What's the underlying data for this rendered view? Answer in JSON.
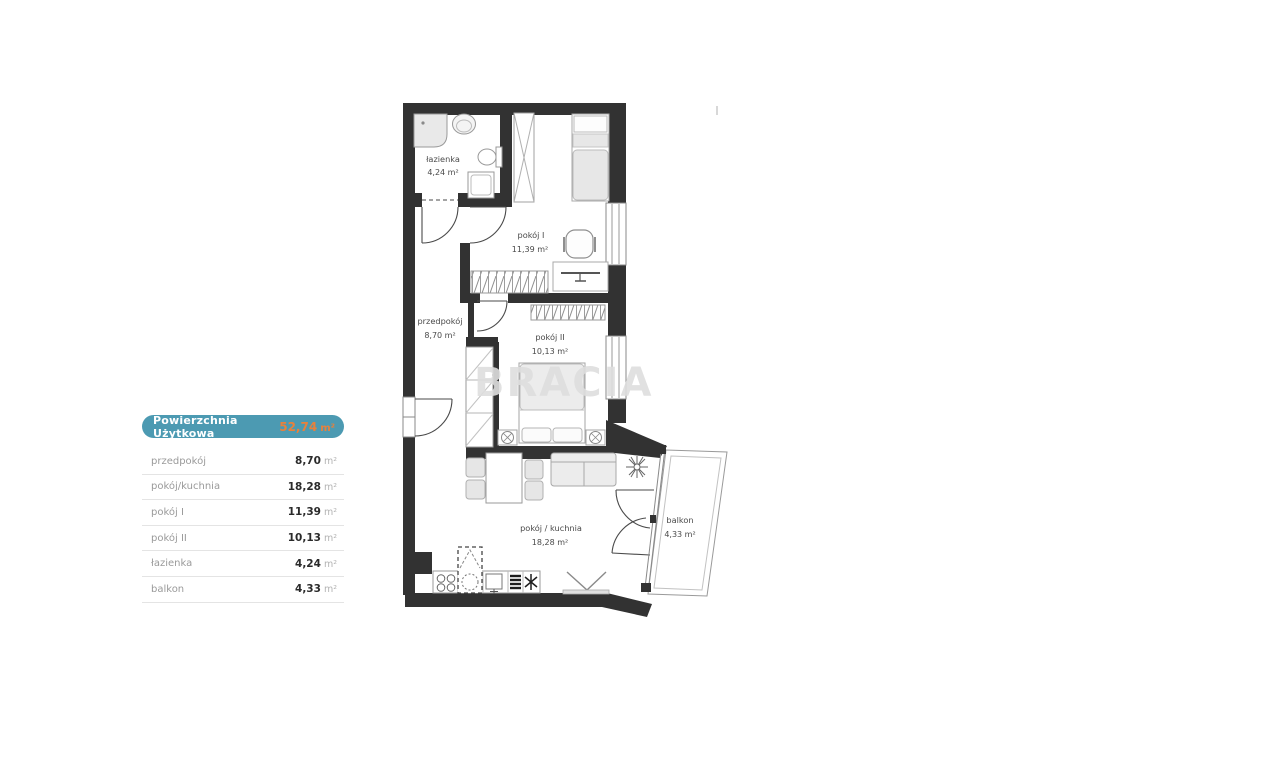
{
  "watermark": {
    "text": "BRACIA"
  },
  "summary_panel": {
    "header": {
      "label": "Powierzchnia Użytkowa",
      "value": "52,74",
      "unit": "m²"
    },
    "rows": [
      {
        "label": "przedpokój",
        "value": "8,70",
        "unit": "m²"
      },
      {
        "label": "pokój/kuchnia",
        "value": "18,28",
        "unit": "m²"
      },
      {
        "label": "pokój I",
        "value": "11,39",
        "unit": "m²"
      },
      {
        "label": "pokój II",
        "value": "10,13",
        "unit": "m²"
      },
      {
        "label": "łazienka",
        "value": "4,24",
        "unit": "m²"
      },
      {
        "label": "balkon",
        "value": "4,33",
        "unit": "m²"
      }
    ]
  },
  "floorplan": {
    "rooms": [
      {
        "name": "łazienka",
        "area": "4,24 m²"
      },
      {
        "name": "pokój I",
        "area": "11,39 m²"
      },
      {
        "name": "przedpokój",
        "area": "8,70 m²"
      },
      {
        "name": "pokój II",
        "area": "10,13 m²"
      },
      {
        "name": "pokój / kuchnia",
        "area": "18,28 m²"
      },
      {
        "name": "balkon",
        "area": "4,33 m²"
      }
    ]
  },
  "colors": {
    "wall": "#323232",
    "accent_teal": "#4c9ab2",
    "accent_orange": "#e8813c"
  }
}
